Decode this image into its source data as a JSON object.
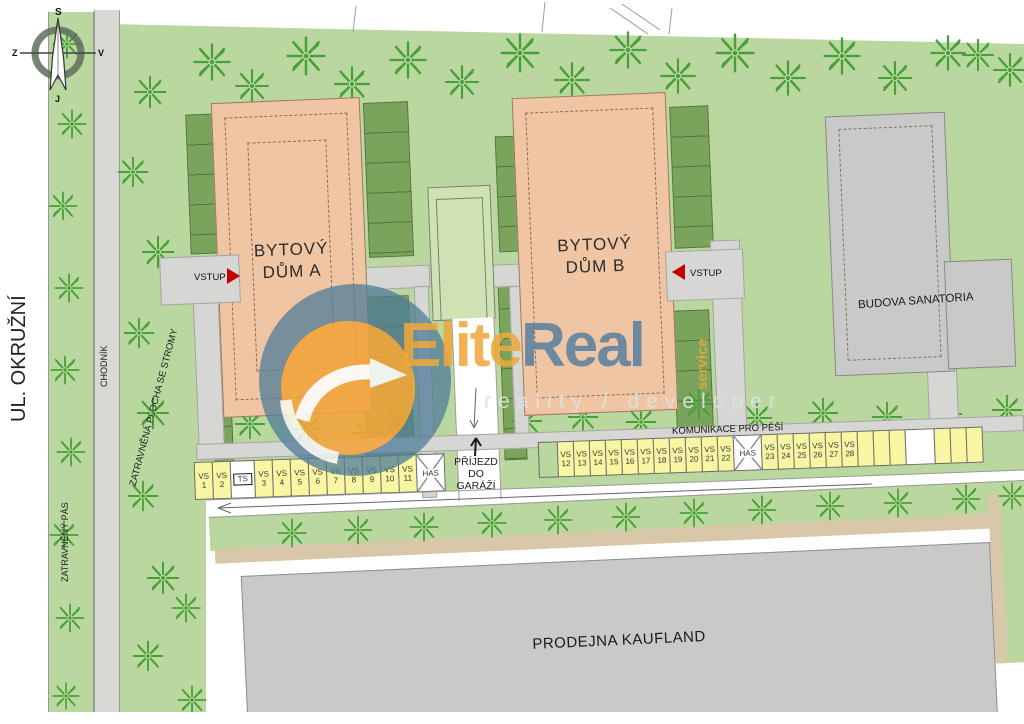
{
  "compass": {
    "north": "S",
    "east": "V",
    "south": "J",
    "west": "Z"
  },
  "street": {
    "name": "UL. OKRUŽNÍ"
  },
  "area_labels": {
    "grass_belt": "ZATRAVNĚNÝ PÁS",
    "sidewalk": "CHODNÍK",
    "grass_area_with_trees": "ZATRAVNĚNÁ PLOCHA SE STROMY",
    "pedestrian_way": "KOMUNIKACE PRO PĚŠÍ",
    "garage_entrance": [
      "PŘÍJEZD",
      "DO",
      "GARÁŽÍ"
    ]
  },
  "buildings": {
    "a": {
      "line1": "BYTOVÝ",
      "line2": "DŮM A",
      "entrance": "VSTUP"
    },
    "b": {
      "line1": "BYTOVÝ",
      "line2": "DŮM B",
      "entrance": "VSTUP"
    },
    "sanatorium": {
      "name": "BUDOVA SANATORIA"
    },
    "kaufland": {
      "name": "PRODEJNA KAUFLAND"
    }
  },
  "parking": {
    "vs_prefix": "VS",
    "row1": [
      {
        "type": "vs",
        "num": "1"
      },
      {
        "type": "vs",
        "num": "2"
      },
      {
        "type": "ts",
        "label": "TS"
      },
      {
        "type": "vs",
        "num": "3"
      },
      {
        "type": "vs",
        "num": "4"
      },
      {
        "type": "vs",
        "num": "5"
      },
      {
        "type": "vs",
        "num": "6"
      },
      {
        "type": "vs",
        "num": "7"
      },
      {
        "type": "vs",
        "num": "8"
      },
      {
        "type": "vs",
        "num": "9"
      },
      {
        "type": "vs",
        "num": "10"
      },
      {
        "type": "vs",
        "num": "11"
      },
      {
        "type": "has",
        "label": "HAS"
      }
    ],
    "row2": [
      {
        "type": "green"
      },
      {
        "type": "vs",
        "num": "12"
      },
      {
        "type": "vs",
        "num": "13"
      },
      {
        "type": "vs",
        "num": "14"
      },
      {
        "type": "vs",
        "num": "15"
      },
      {
        "type": "vs",
        "num": "16"
      },
      {
        "type": "vs",
        "num": "17"
      },
      {
        "type": "vs",
        "num": "18"
      },
      {
        "type": "vs",
        "num": "19"
      },
      {
        "type": "vs",
        "num": "20"
      },
      {
        "type": "vs",
        "num": "21"
      },
      {
        "type": "vs",
        "num": "22"
      },
      {
        "type": "has",
        "label": "HAS"
      },
      {
        "type": "vs",
        "num": "23"
      },
      {
        "type": "vs",
        "num": "24"
      },
      {
        "type": "vs",
        "num": "25"
      },
      {
        "type": "vs",
        "num": "26"
      },
      {
        "type": "vs",
        "num": "27"
      },
      {
        "type": "vs",
        "num": "28"
      },
      {
        "type": "blank"
      },
      {
        "type": "blank"
      },
      {
        "type": "blank"
      },
      {
        "type": "gap"
      },
      {
        "type": "blank"
      },
      {
        "type": "blank"
      },
      {
        "type": "blank"
      }
    ]
  },
  "watermark": {
    "brand1": "Elite",
    "brand2": "Real",
    "vertical": "service",
    "tagline": "reality / developer"
  },
  "icons": {
    "tree": "tree-icon",
    "compass": "compass-icon",
    "entrance_arrow": "entrance-arrow-icon"
  },
  "colors": {
    "site_green": "#b9d79e",
    "tree_green": "#47a138",
    "garage_green": "#7aa35c",
    "building_salmon": "#f0c5a4",
    "building_gray": "#c9cac7",
    "parking_yellow": "#f8f6a3",
    "path_gray": "#d6d7d4",
    "sidewalk_tan": "#d9c7aa",
    "entrance_red": "#c40000",
    "brand_orange": "#efa83c",
    "brand_blue": "#5a81a0"
  }
}
